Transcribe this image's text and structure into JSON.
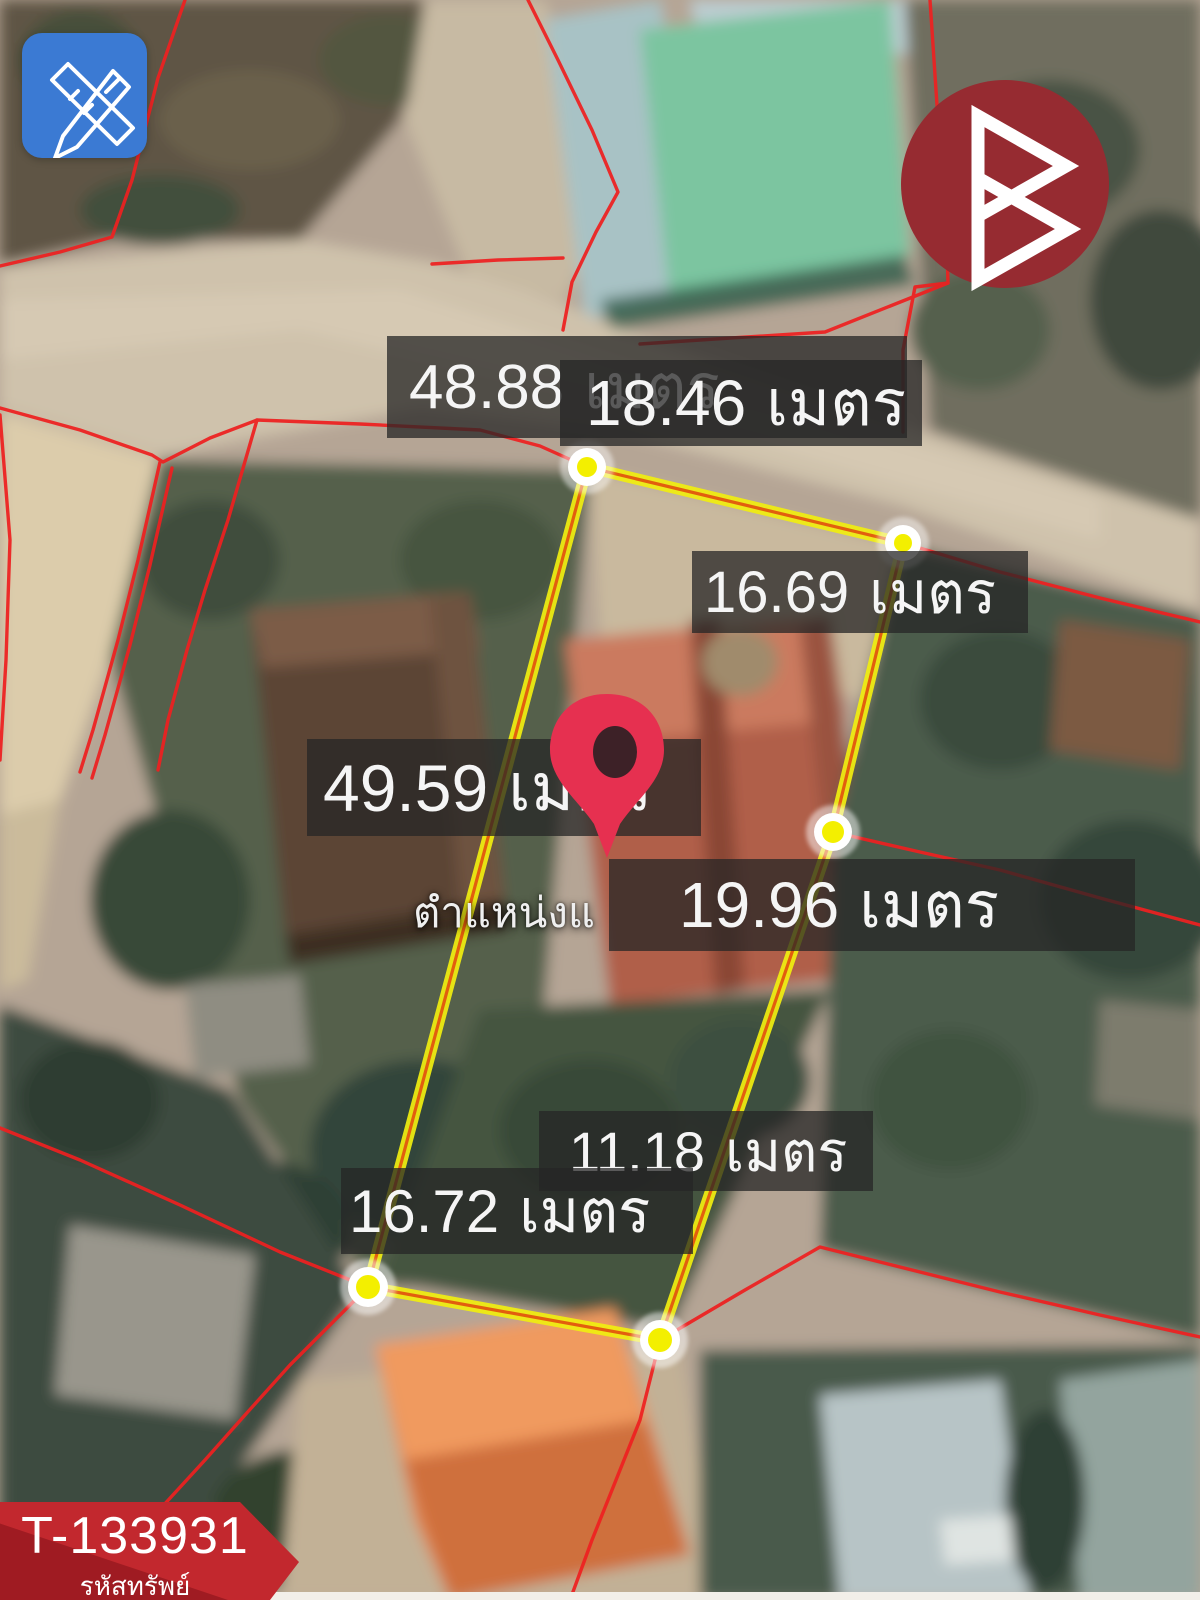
{
  "map": {
    "unit_word": "เมตร",
    "position_marker_label": "ตำแหน่งแ",
    "measurements": [
      {
        "side": "top-rear-boundary",
        "value": "48.88"
      },
      {
        "side": "top-boundary",
        "value": "18.46"
      },
      {
        "side": "upper-right-boundary",
        "value": "16.69"
      },
      {
        "side": "left-boundary",
        "value": "49.59"
      },
      {
        "side": "right-boundary",
        "value": "19.96"
      },
      {
        "side": "lower-right-boundary",
        "value": "11.18"
      },
      {
        "side": "bottom-boundary",
        "value": "16.72"
      }
    ]
  },
  "property": {
    "code": "T-133931",
    "code_caption": "รหัสทรัพย์"
  },
  "icons": {
    "edit_tool": "pencil-ruler-icon",
    "brand": "triangle-b-logo",
    "marker": "map-pin-icon"
  },
  "colors": {
    "plot_boundary_yellow": "#f0ed10",
    "boundary_core_orange": "#e1560e",
    "parcel_line_red": "#ee2020",
    "label_background": "rgba(38,38,38,0.75)",
    "banner_red": "#c2282e",
    "logo_maroon": "#962b31",
    "edit_button_blue": "#3b7ad3",
    "pin_red": "#e63050"
  }
}
